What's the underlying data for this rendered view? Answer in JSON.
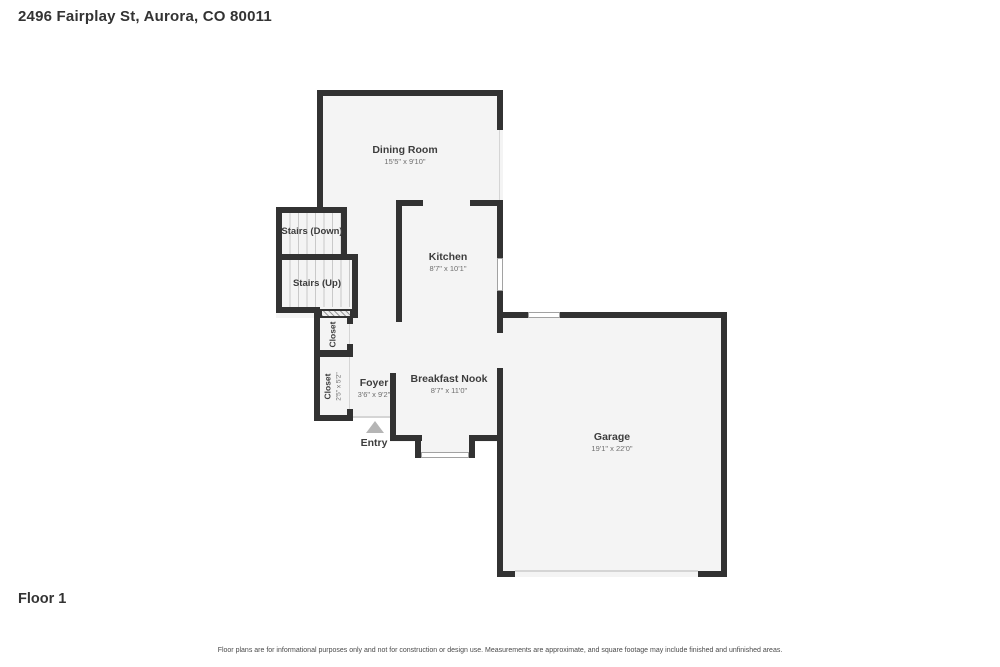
{
  "header": {
    "address": "2496 Fairplay St, Aurora, CO 80011"
  },
  "footer": {
    "floor_label": "Floor 1",
    "disclaimer": "Floor plans are for informational purposes only and not for construction or design use. Measurements are approximate, and square footage may include finished and unfinished areas."
  },
  "floorplan": {
    "rooms": {
      "dining": {
        "name": "Dining Room",
        "dims": "15'5\" x 9'10\""
      },
      "kitchen": {
        "name": "Kitchen",
        "dims": "8'7\" x 10'1\""
      },
      "nook": {
        "name": "Breakfast Nook",
        "dims": "8'7\" x 11'0\""
      },
      "foyer": {
        "name": "Foyer",
        "dims": "3'6\" x 9'2\""
      },
      "garage": {
        "name": "Garage",
        "dims": "19'1\" x 22'0\""
      },
      "stairs_down": {
        "name": "Stairs (Down)"
      },
      "stairs_up": {
        "name": "Stairs (Up)"
      },
      "closet_a": {
        "name": "Closet"
      },
      "closet_b": {
        "name": "Closet",
        "dims": "2'5\" x 5'2\""
      },
      "entry": {
        "name": "Entry"
      }
    },
    "colors": {
      "wall": "#323232",
      "room_fill": "#f4f4f4",
      "window_line": "#a2a2a2",
      "stair_tread": "#c9c9c9",
      "entry_triangle": "#b5b5b5",
      "text_primary": "#3d3d3d",
      "text_secondary": "#6e6e6e"
    }
  }
}
